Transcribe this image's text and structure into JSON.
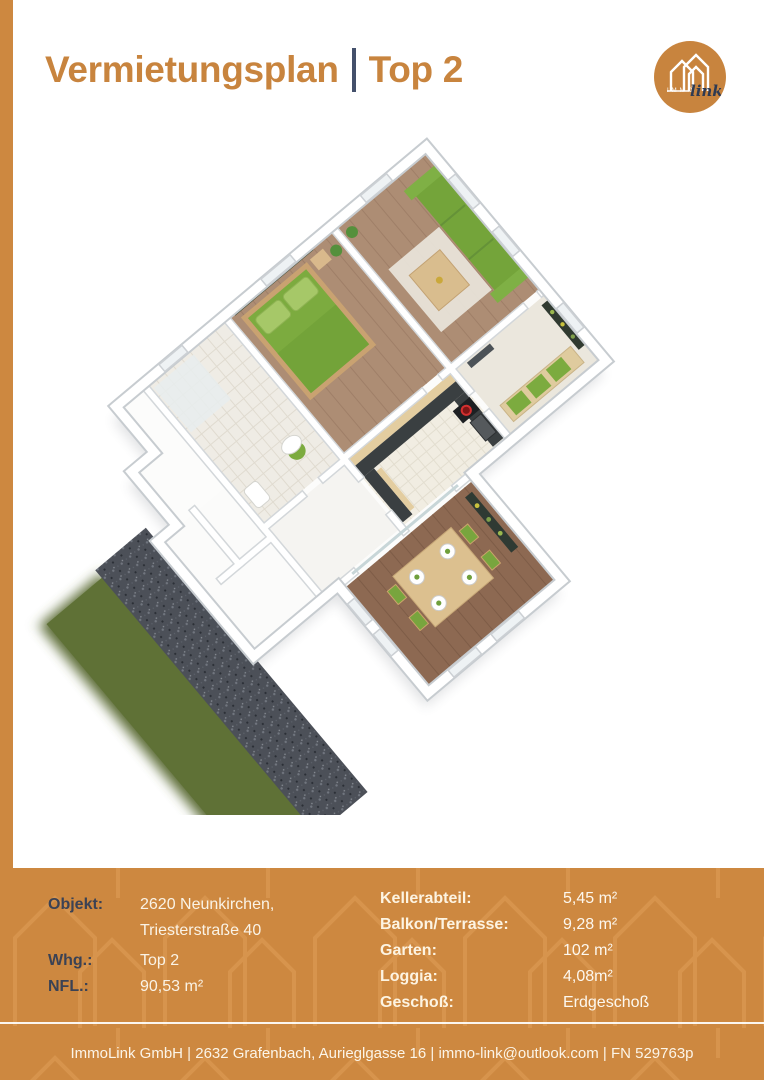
{
  "header": {
    "title_main": "Vermietungsplan",
    "title_sub": "Top 2"
  },
  "logo": {
    "small_text": "immo",
    "script_text": "link"
  },
  "details": {
    "left": [
      {
        "label": "Objekt:",
        "value1": "2620 Neunkirchen,",
        "value2": "Triesterstraße 40"
      },
      {
        "label": "Whg.:",
        "value1": "Top 2"
      },
      {
        "label": "NFL.:",
        "value1": "90,53 m²"
      }
    ],
    "right": [
      {
        "label": "Kellerabteil:",
        "value": "5,45 m²"
      },
      {
        "label": "Balkon/Terrasse:",
        "value": "9,28 m²"
      },
      {
        "label": "Garten:",
        "value": "102 m²"
      },
      {
        "label": "Loggia:",
        "value": "4,08m²"
      },
      {
        "label": "Geschoß:",
        "value": "Erdgeschoß"
      }
    ]
  },
  "footer": {
    "text": "ImmoLink GmbH | 2632 Grafenbach, Aurieglgasse 16 | immo-link@outlook.com | FN 529763p"
  },
  "colors": {
    "brand_orange": "#cd8840",
    "accent_navy": "#44506b",
    "label_dark": "#3b4254",
    "value_light": "#faf3e6",
    "furniture_green": "#7cab3f",
    "wood_floor": "#ad8d74"
  }
}
